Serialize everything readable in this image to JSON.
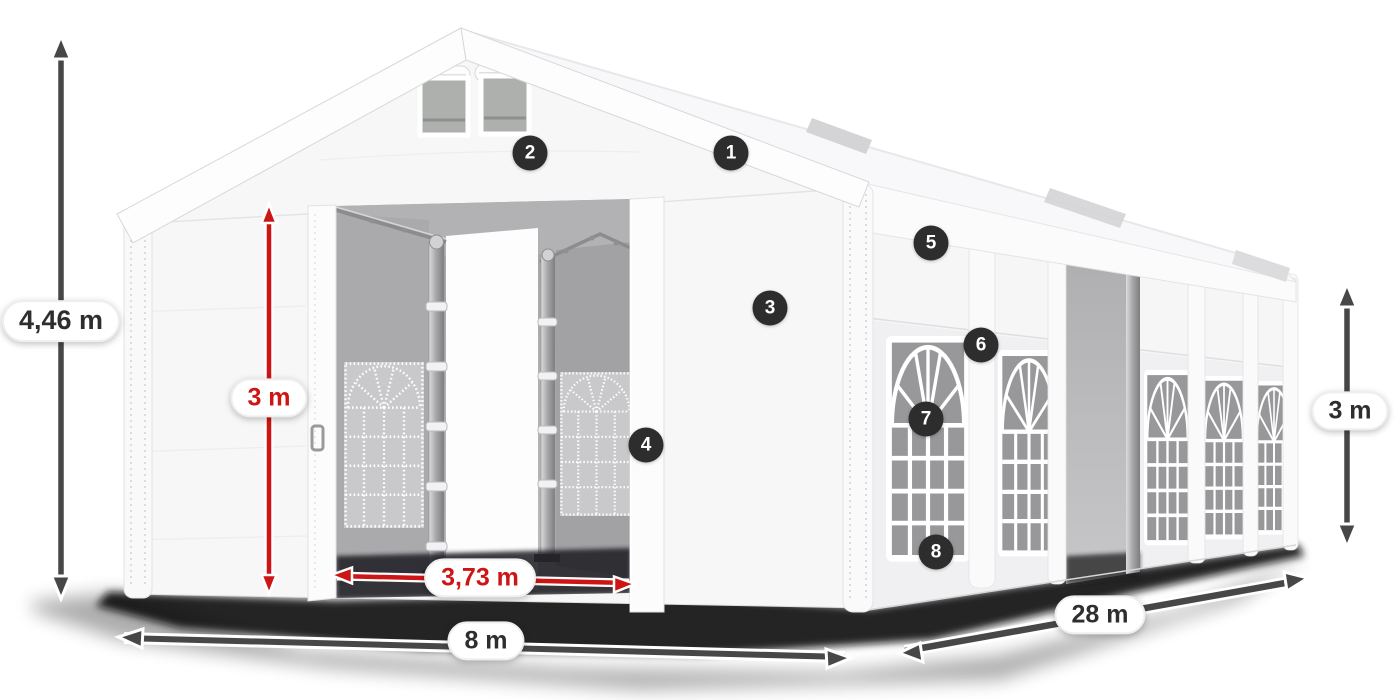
{
  "dimensions": {
    "total_height": {
      "text": "4,46 m",
      "style": "gray"
    },
    "door_height": {
      "text": "3 m",
      "style": "red"
    },
    "door_width": {
      "text": "3,73 m",
      "style": "red"
    },
    "front_width": {
      "text": "8 m",
      "style": "gray"
    },
    "side_length": {
      "text": "28 m",
      "style": "gray"
    },
    "side_height": {
      "text": "3 m",
      "style": "gray"
    }
  },
  "hotspots": [
    {
      "number": "1"
    },
    {
      "number": "2"
    },
    {
      "number": "3"
    },
    {
      "number": "4"
    },
    {
      "number": "5"
    },
    {
      "number": "6"
    },
    {
      "number": "7"
    },
    {
      "number": "8"
    }
  ],
  "colors": {
    "dimension_red": "#cd1515",
    "dimension_gray": "#474747",
    "badge_background": "#2d2d2d",
    "badge_text": "#ffffff"
  }
}
